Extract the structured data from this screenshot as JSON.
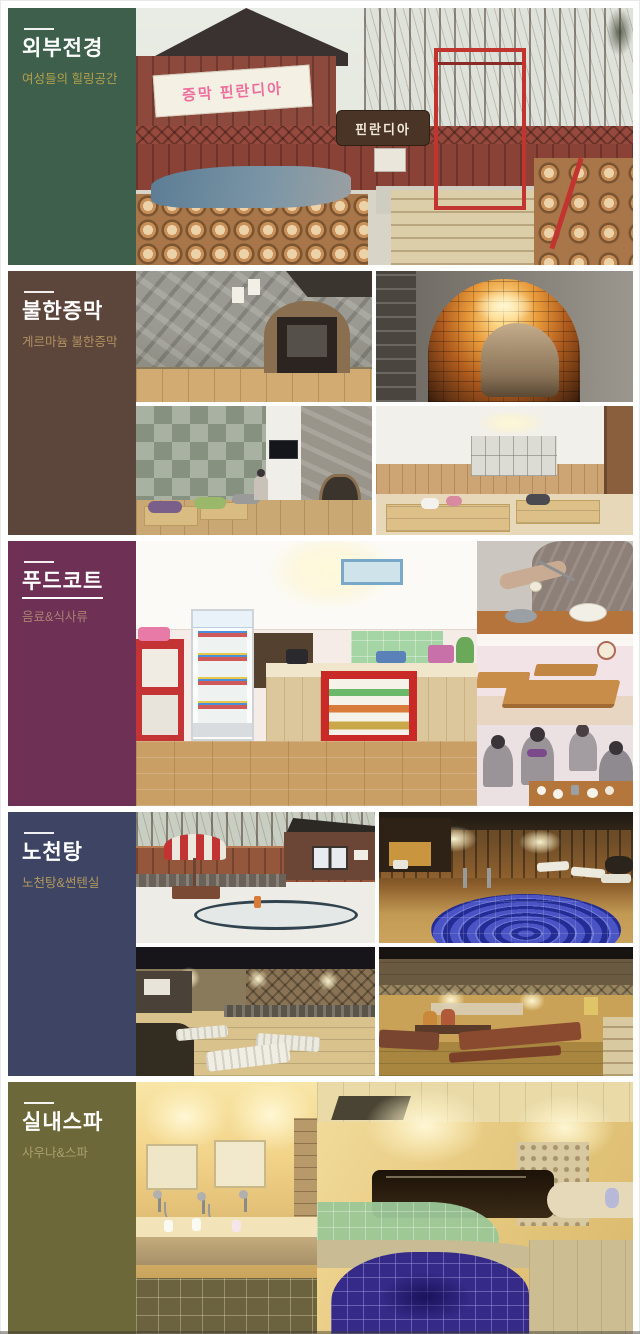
{
  "page": {
    "background": "#ffffff"
  },
  "sections": [
    {
      "id": "exterior",
      "title": "외부전경",
      "subtitle": "여성들의 힐링공간",
      "sidebar_color": "#3d5f4c",
      "subtitle_color": "#b2a04c",
      "photo_texts": {
        "window_banner": "증막 핀란디아",
        "wood_sign": "핀란디아"
      }
    },
    {
      "id": "bulhan-sauna",
      "title": "불한증막",
      "subtitle": "게르마늄 불한증막",
      "sidebar_color": "#5c453b",
      "subtitle_color": "#b1905f"
    },
    {
      "id": "food-court",
      "title": "푸드코트",
      "subtitle": "음료&식사류",
      "sidebar_color": "#6e3055",
      "subtitle_color": "#aa8072"
    },
    {
      "id": "open-air-bath",
      "title": "노천탕",
      "subtitle": "노천탕&썬텐실",
      "sidebar_color": "#3e4464",
      "subtitle_color": "#b29a5e"
    },
    {
      "id": "indoor-spa",
      "title": "실내스파",
      "subtitle": "사우나&스파",
      "sidebar_color": "#6d6839",
      "subtitle_color": "#a99f6b"
    }
  ]
}
